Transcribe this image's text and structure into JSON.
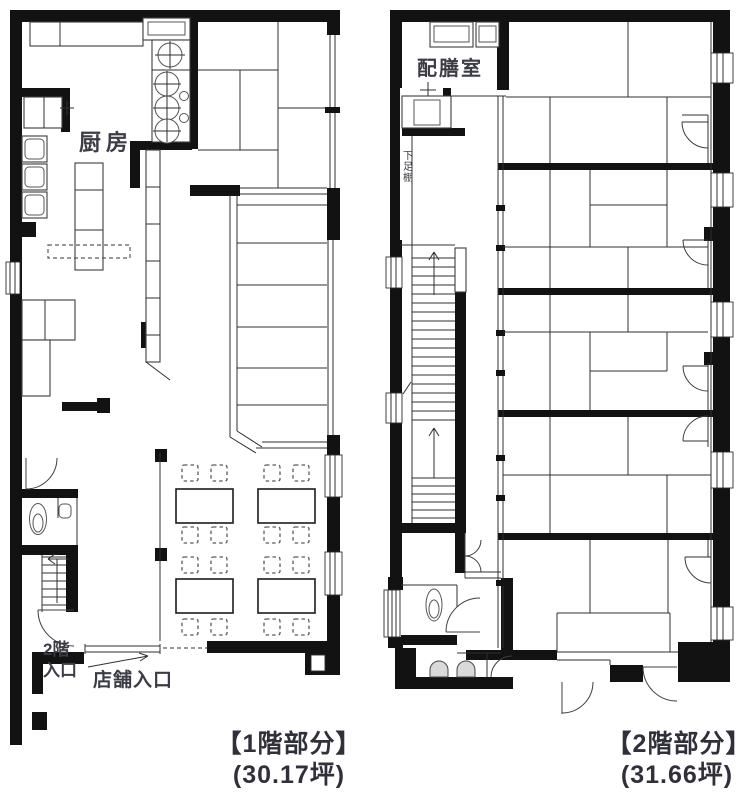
{
  "document": {
    "type": "building-floor-plan",
    "background_color": "#ffffff",
    "wall_color": "#121212",
    "thin_line_color": "#2f2f2f",
    "label_color": "#3c3c46",
    "caption_color": "#30303a"
  },
  "floor1": {
    "labels": {
      "kitchen": "厨房",
      "upstairs_entrance_line1": "2階",
      "upstairs_entrance_line2": "入口",
      "store_entrance": "店舗入口"
    },
    "caption": {
      "title": "【1階部分】",
      "area": "(30.17坪)"
    }
  },
  "floor2": {
    "labels": {
      "serving_room": "配膳室",
      "shoe_rack": "下足棚"
    },
    "caption": {
      "title": "【2階部分】",
      "area": "(31.66坪)"
    }
  }
}
